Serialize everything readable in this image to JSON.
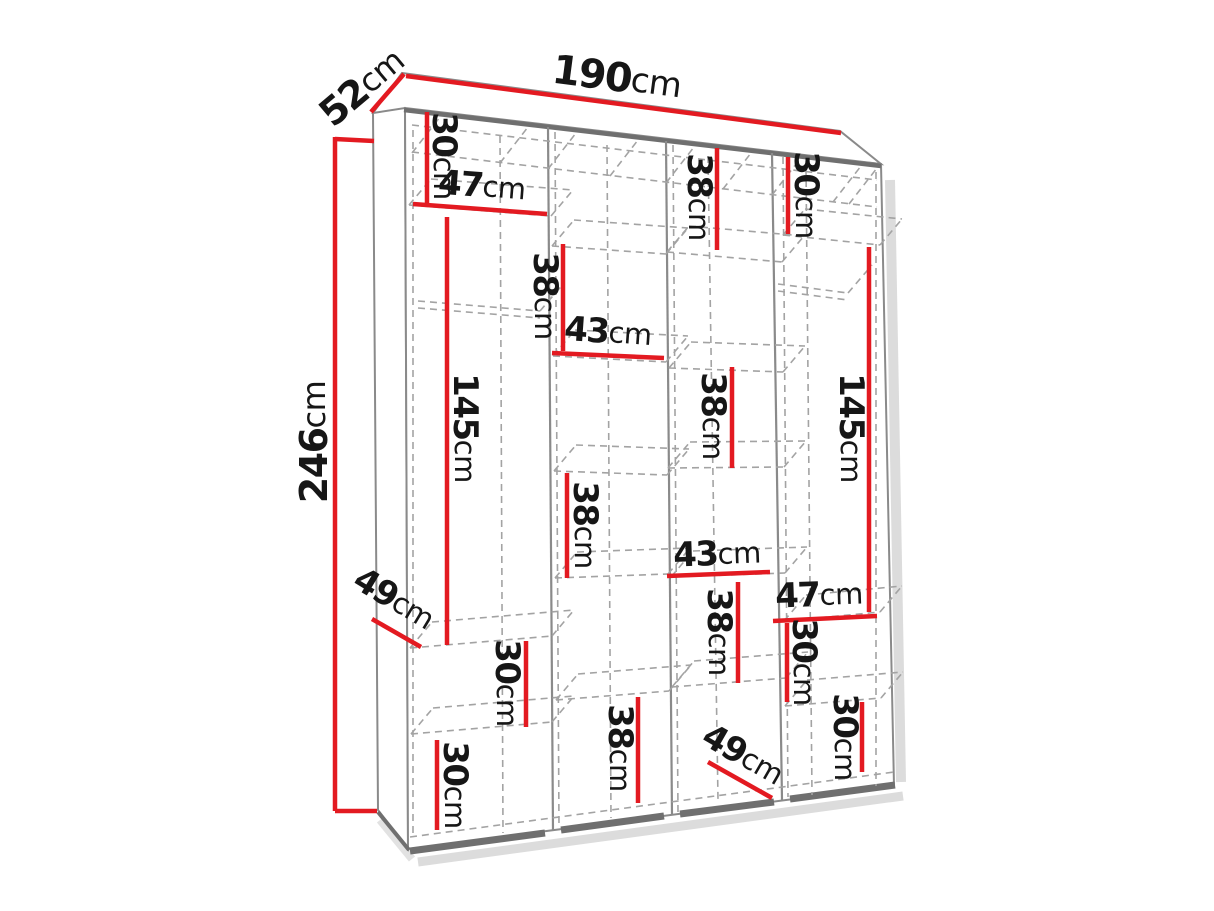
{
  "figure": {
    "kind": "wardrobe-dimension-diagram",
    "unit": "cm"
  },
  "colors": {
    "dimension_line": "#e31a21",
    "structure_line": "#8a8a8a",
    "structure_edge_dark": "#6f6f6f",
    "dashed_line": "#a3a3a3",
    "label_text": "#161616",
    "shadow": "#dcdcdc",
    "background": "#ffffff"
  },
  "overall_dimensions": {
    "width": "190",
    "depth": "52",
    "height": "246"
  },
  "dimensions": [
    {
      "id": "overall-width-top",
      "value": "190",
      "unit": "cm"
    },
    {
      "id": "overall-depth-top",
      "value": "52",
      "unit": "cm"
    },
    {
      "id": "overall-height-left",
      "value": "246",
      "unit": "cm"
    },
    {
      "id": "sec1-top-30",
      "value": "30",
      "unit": "cm"
    },
    {
      "id": "sec1-width-47",
      "value": "47",
      "unit": "cm"
    },
    {
      "id": "sec1-hanging-145",
      "value": "145",
      "unit": "cm"
    },
    {
      "id": "sec1-depth-49",
      "value": "49",
      "unit": "cm"
    },
    {
      "id": "sec1-mid-30",
      "value": "30",
      "unit": "cm"
    },
    {
      "id": "sec1-bottom-30",
      "value": "30",
      "unit": "cm"
    },
    {
      "id": "sec2-top-38",
      "value": "38",
      "unit": "cm"
    },
    {
      "id": "sec2-width-43",
      "value": "43",
      "unit": "cm"
    },
    {
      "id": "sec2-mid-38",
      "value": "38",
      "unit": "cm"
    },
    {
      "id": "sec2-bottom-38",
      "value": "38",
      "unit": "cm"
    },
    {
      "id": "sec3-top-38",
      "value": "38",
      "unit": "cm"
    },
    {
      "id": "sec3-upper-38",
      "value": "38",
      "unit": "cm"
    },
    {
      "id": "sec3-width-43",
      "value": "43",
      "unit": "cm"
    },
    {
      "id": "sec3-lower-38",
      "value": "38",
      "unit": "cm"
    },
    {
      "id": "sec3-depth-49",
      "value": "49",
      "unit": "cm"
    },
    {
      "id": "sec4-top-30",
      "value": "30",
      "unit": "cm"
    },
    {
      "id": "sec4-hanging-145",
      "value": "145",
      "unit": "cm"
    },
    {
      "id": "sec4-width-47",
      "value": "47",
      "unit": "cm"
    },
    {
      "id": "sec4-mid-30",
      "value": "30",
      "unit": "cm"
    },
    {
      "id": "sec4-bottom-30",
      "value": "30",
      "unit": "cm"
    }
  ]
}
